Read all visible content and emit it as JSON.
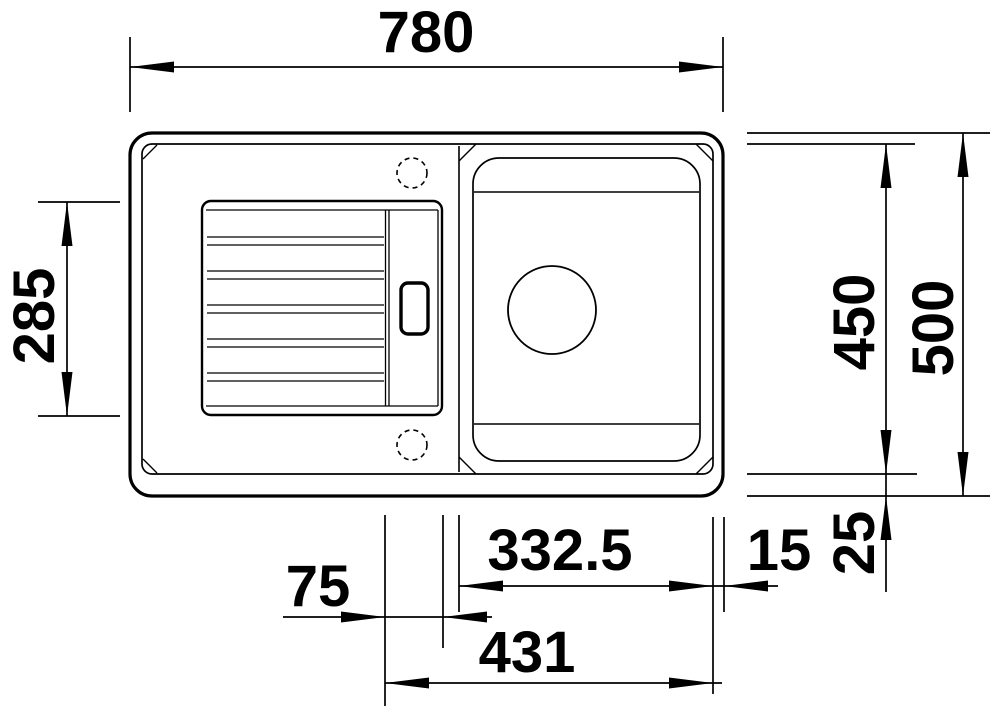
{
  "drawing": {
    "background": "#ffffff",
    "ink": "#000000",
    "parts": [
      "sink-outer-edge",
      "sink-inner-rim",
      "drainboard",
      "drainboard-ribs",
      "slide-strip",
      "handle-recess",
      "bowl",
      "drain-hole",
      "tap-hole-top",
      "tap-hole-bottom"
    ]
  },
  "dims": {
    "d780": {
      "label": "780"
    },
    "d285": {
      "label": "285"
    },
    "d450": {
      "label": "450"
    },
    "d500": {
      "label": "500"
    },
    "d332_5": {
      "label": "332.5"
    },
    "d15": {
      "label": "15"
    },
    "d25": {
      "label": "25"
    },
    "d75": {
      "label": "75"
    },
    "d431": {
      "label": "431"
    }
  }
}
